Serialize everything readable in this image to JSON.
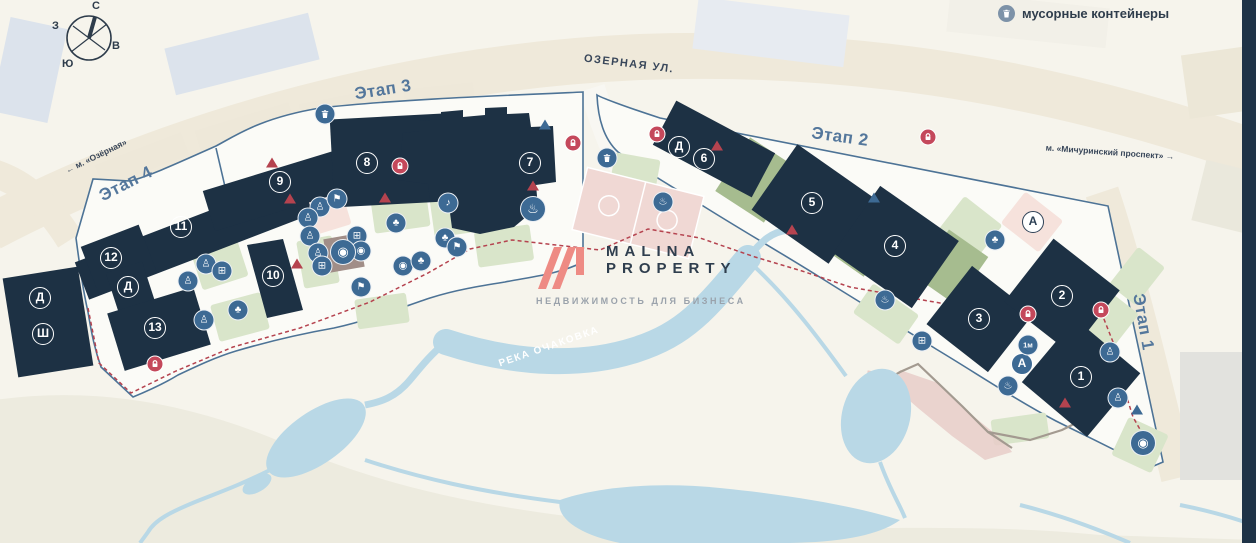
{
  "compass": {
    "north": "С",
    "south": "Ю",
    "west": "З",
    "east": "В"
  },
  "legend": {
    "trash_label": "мусорные контейнеры"
  },
  "streets": {
    "ozernaya": "ОЗЕРНАЯ УЛ."
  },
  "metro": {
    "ozernaya": "м. «Озёрная»",
    "ozernaya_arrow": "←",
    "michurinsky": "м. «Мичуринский проспект»",
    "michurinsky_arrow": "→"
  },
  "stages": {
    "stage1": "Этап 1",
    "stage2": "Этап 2",
    "stage3": "Этап 3",
    "stage4": "Этап 4"
  },
  "river": {
    "name": "РЕКА ОЧАКОВКА"
  },
  "watermark": {
    "brand_line1": "MALINA",
    "brand_line2": "PROPERTY",
    "subtitle": "НЕДВИЖИМОСТЬ ДЛЯ БИЗНЕСА"
  },
  "buildings": {
    "n1": "1",
    "n2": "2",
    "n3": "3",
    "n4": "4",
    "n5": "5",
    "n6": "6",
    "n7": "7",
    "n8": "8",
    "n9": "9",
    "n10": "10",
    "n11": "11",
    "n12": "12",
    "n13": "13",
    "d": "Д",
    "sh": "Ш",
    "a": "А"
  },
  "icon_glyphs": {
    "tree": "♣",
    "ball": "◉",
    "grill": "♨",
    "music": "♪",
    "playground": "♙",
    "flag": "⚑",
    "gym": "⊞",
    "height_mark": "1м"
  },
  "colors": {
    "building": "#1d3144",
    "stage_line": "#4d7396",
    "water": "#b9d8e6",
    "lock": "#c4485b",
    "poi": "#3d6a94",
    "accent_red": "#b5434f",
    "logo_pink": "#ee8b84"
  }
}
